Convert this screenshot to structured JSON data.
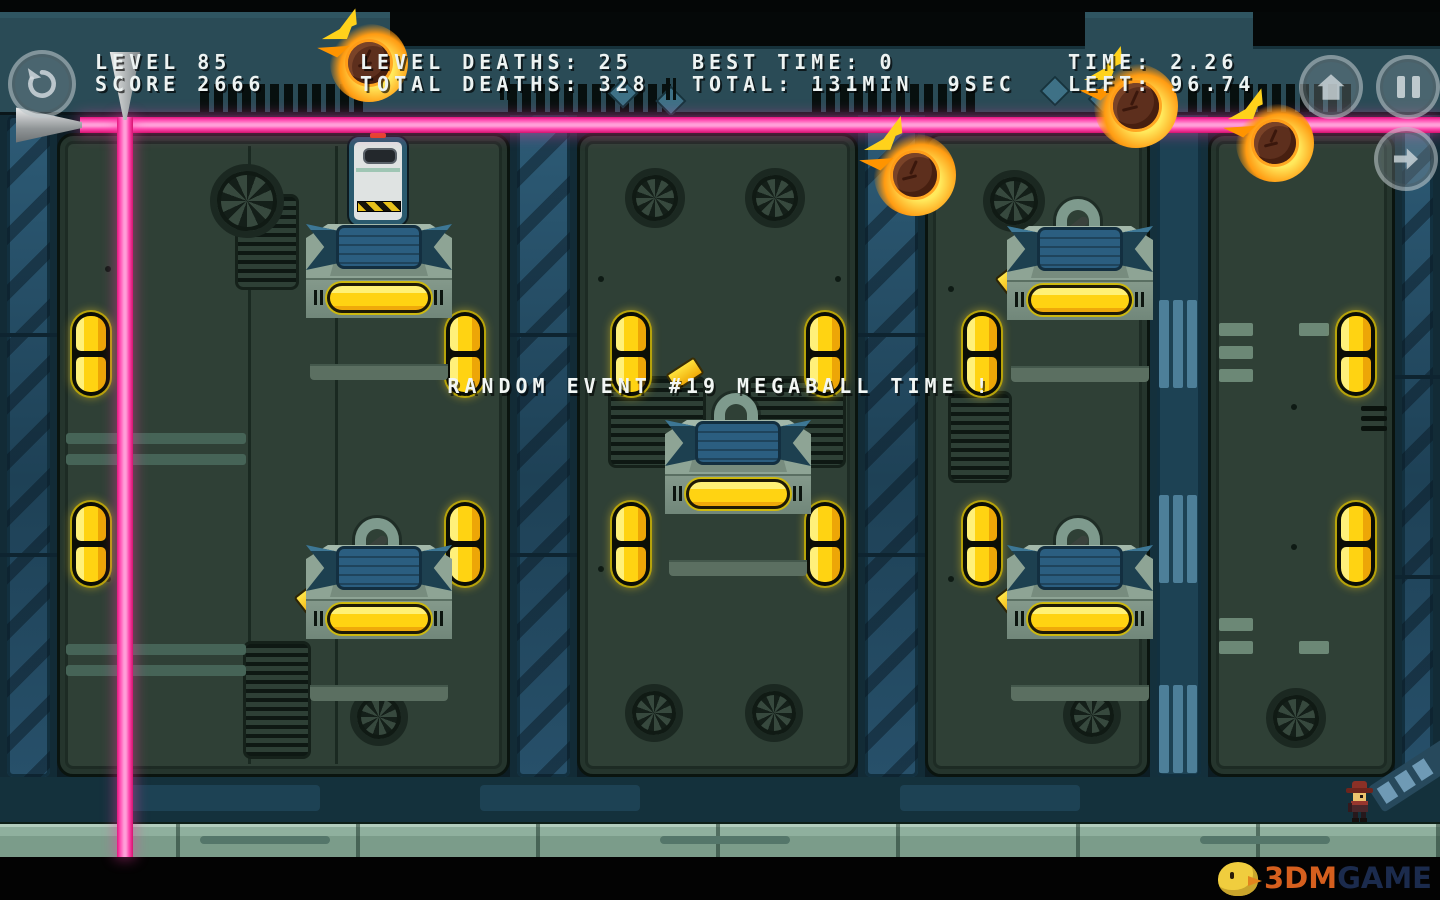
{
  "hud": {
    "level": "LEVEL 85",
    "score": "SCORE 2666",
    "level_deaths": "LEVEL DEATHS: 25",
    "total_deaths": "TOTAL DEATHS: 328",
    "best_time": "BEST TIME: 0",
    "total_time": "TOTAL: 131MIN  9SEC",
    "time": "TIME: 2.26",
    "time_left": "LEFT: 96.74"
  },
  "event_banner": "RANDOM EVENT #19 MEGABALL TIME !",
  "buttons": {
    "restart_icon": "restart-circular-arrow",
    "home_icon": "home-house",
    "pause_icon": "pause-bars",
    "next_icon": "next-arrow"
  },
  "watermark": {
    "brand_orange": "3DM",
    "brand_blue": "GAME"
  },
  "colors": {
    "laser_pink_core": "#ff9ed8",
    "laser_pink_edge": "#e2187e",
    "capsule_yellow": "#ffd312",
    "machine_body": "#8ea495",
    "machine_lower_blue": "#2b5e80",
    "hud_band": "#2a4b56",
    "door_face": "#2f4036",
    "floor_green": "#8fb09e",
    "fireball_core": "#5d2f1d",
    "fireball_flame": "#ff9b12"
  }
}
